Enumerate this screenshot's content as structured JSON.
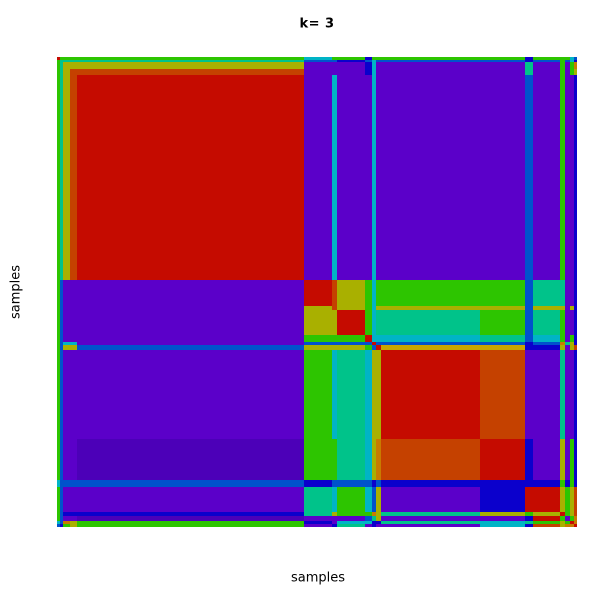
{
  "title": "k= 3",
  "x_axis_label": "samples",
  "y_axis_label": "samples",
  "background_color": "#ffffff",
  "text_color": "#000000",
  "chart_data": {
    "type": "heatmap",
    "title": "k= 3",
    "xlabel": "samples",
    "ylabel": "samples",
    "description": "Consensus clustering matrix for k=3: ordered samples on both axes, block-diagonal structure (large red cluster top-left, mosaic middle cluster, red cluster bottom-right) over purple off-diagonal background with thin green/teal/blue/olive edge stripes",
    "grid": false,
    "axis_ticks": "none",
    "legend": "none",
    "plot_area": {
      "left": 57,
      "top": 57,
      "width": 520,
      "height": 470
    },
    "palette": {
      "R": "#c50b00",
      "r": "#c54100",
      "O": "#c87b00",
      "Y": "#c9a500",
      "y": "#a9b000",
      "G": "#2dc500",
      "T": "#00c38a",
      "C": "#00b4c6",
      "B": "#0052cc",
      "b": "#0b00cc",
      "P": "#5b00c9",
      "p": "#4c00b8"
    },
    "segments_px": [
      3,
      3,
      7,
      7,
      227,
      28,
      5,
      28,
      7,
      4,
      5,
      99,
      45,
      8,
      27,
      5,
      5,
      4,
      3
    ],
    "grid_rows": [
      "RGGGGCGGbGGGGbGGGCB",
      "GTTTTBBbBCBBBbBGBCb",
      "GTyyyPPPbCPPPTPGPGO",
      "GTyrrPPPbCPPPTPGPGy",
      "GTyrRPCPPCPPPBPGPPb",
      "GBPPPRryGCGGGBTTPPb",
      "GBPPPyryGCyyyByyPyb",
      "GBPPPyyRGCTTGBTGPPb",
      "GBPPPGGGRCCCTBCGPGb",
      "GBCCPBBBBRBBBbBOTyb",
      "GByyByyyGBRYYbbyPyr",
      "GBPPPGCTCyyRrPPTPPb",
      "GBPPpGGTCyOrRbPyPGb",
      "CBBBBbBBBbBbbbbGbGb",
      "GBPPPTCGCByPbRRyGyr",
      "GBbbbTyGGOyTyGyRGyr",
      "GBPPpPPPBTyPPbRGPGO",
      "CBOyGbPCCbbTCTGyGRO",
      "BbGyGPbTPbPPCbryOOR"
    ]
  }
}
